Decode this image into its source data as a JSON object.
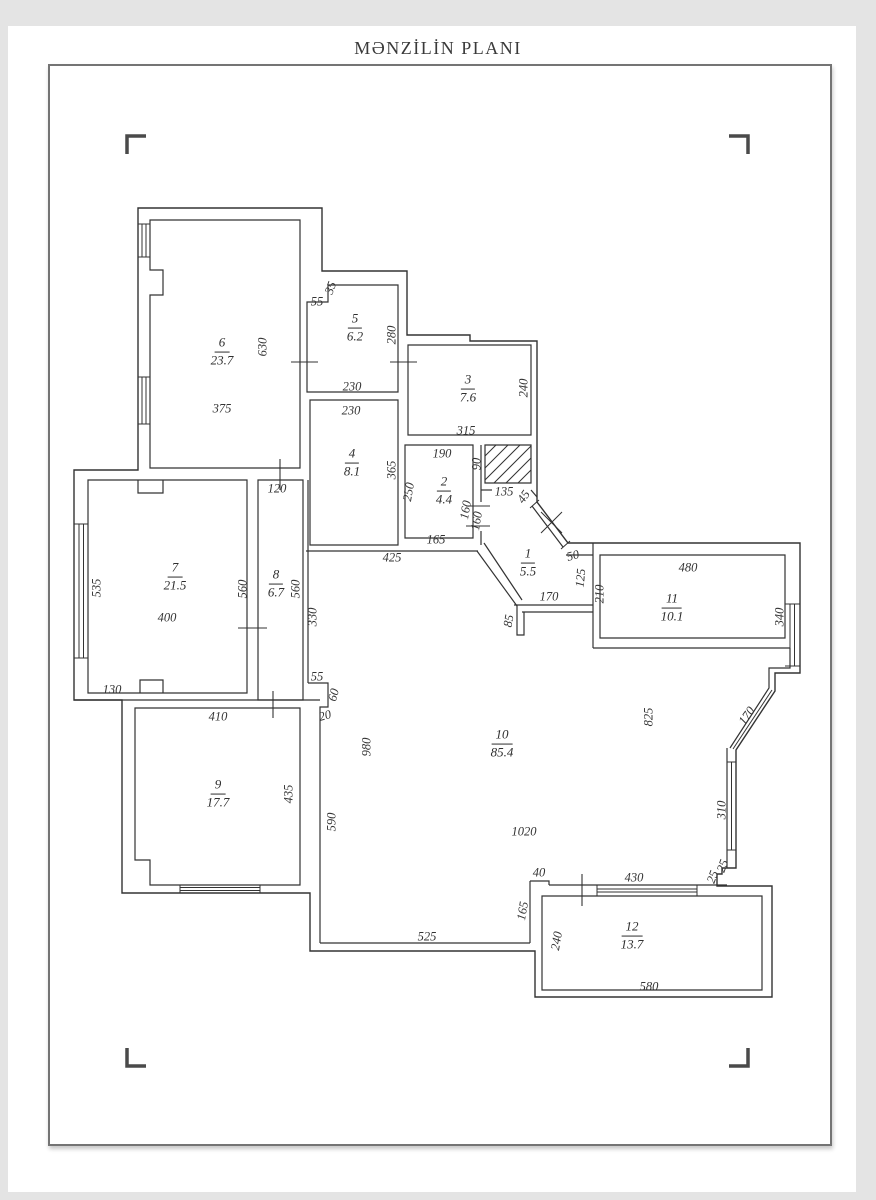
{
  "title": "MƏNZİLİN PLANI",
  "plan": {
    "rooms": [
      {
        "num": "6",
        "area": "23.7",
        "x": 222,
        "y": 352
      },
      {
        "num": "5",
        "area": "6.2",
        "x": 355,
        "y": 328
      },
      {
        "num": "3",
        "area": "7.6",
        "x": 468,
        "y": 389
      },
      {
        "num": "4",
        "area": "8.1",
        "x": 352,
        "y": 463
      },
      {
        "num": "2",
        "area": "4.4",
        "x": 444,
        "y": 491
      },
      {
        "num": "1",
        "area": "5.5",
        "x": 528,
        "y": 563
      },
      {
        "num": "7",
        "area": "21.5",
        "x": 175,
        "y": 577
      },
      {
        "num": "8",
        "area": "6.7",
        "x": 276,
        "y": 584
      },
      {
        "num": "9",
        "area": "17.7",
        "x": 218,
        "y": 794
      },
      {
        "num": "10",
        "area": "85.4",
        "x": 502,
        "y": 744
      },
      {
        "num": "11",
        "area": "10.1",
        "x": 672,
        "y": 608
      },
      {
        "num": "12",
        "area": "13.7",
        "x": 632,
        "y": 936
      }
    ],
    "dimensions": [
      {
        "t": "630",
        "x": 263,
        "y": 347,
        "r": -90
      },
      {
        "t": "375",
        "x": 222,
        "y": 409,
        "r": 0
      },
      {
        "t": "55",
        "x": 317,
        "y": 302,
        "r": 0
      },
      {
        "t": "35",
        "x": 331,
        "y": 288,
        "r": -70
      },
      {
        "t": "280",
        "x": 392,
        "y": 335,
        "r": -90
      },
      {
        "t": "230",
        "x": 352,
        "y": 387,
        "r": 0
      },
      {
        "t": "230",
        "x": 351,
        "y": 411,
        "r": 0
      },
      {
        "t": "315",
        "x": 466,
        "y": 431,
        "r": 0
      },
      {
        "t": "240",
        "x": 524,
        "y": 388,
        "r": -90
      },
      {
        "t": "365",
        "x": 392,
        "y": 470,
        "r": -90
      },
      {
        "t": "190",
        "x": 442,
        "y": 454,
        "r": 0
      },
      {
        "t": "90",
        "x": 477,
        "y": 464,
        "r": -90
      },
      {
        "t": "250",
        "x": 409,
        "y": 492,
        "r": -80
      },
      {
        "t": "135",
        "x": 504,
        "y": 492,
        "r": 0
      },
      {
        "t": "45",
        "x": 524,
        "y": 497,
        "r": -55
      },
      {
        "t": "160",
        "x": 466,
        "y": 510,
        "r": -80
      },
      {
        "t": "160",
        "x": 477,
        "y": 521,
        "r": -80
      },
      {
        "t": "165",
        "x": 436,
        "y": 540,
        "r": 0
      },
      {
        "t": "425",
        "x": 392,
        "y": 558,
        "r": 0
      },
      {
        "t": "50",
        "x": 573,
        "y": 556,
        "r": -15
      },
      {
        "t": "125",
        "x": 581,
        "y": 578,
        "r": -85
      },
      {
        "t": "170",
        "x": 549,
        "y": 597,
        "r": 0
      },
      {
        "t": "85",
        "x": 509,
        "y": 621,
        "r": -80
      },
      {
        "t": "210",
        "x": 600,
        "y": 594,
        "r": -90
      },
      {
        "t": "480",
        "x": 688,
        "y": 568,
        "r": 0
      },
      {
        "t": "340",
        "x": 780,
        "y": 617,
        "r": -90
      },
      {
        "t": "120",
        "x": 277,
        "y": 489,
        "r": 0
      },
      {
        "t": "560",
        "x": 243,
        "y": 589,
        "r": -90
      },
      {
        "t": "560",
        "x": 296,
        "y": 589,
        "r": -90
      },
      {
        "t": "535",
        "x": 97,
        "y": 588,
        "r": -90
      },
      {
        "t": "400",
        "x": 167,
        "y": 618,
        "r": 0
      },
      {
        "t": "130",
        "x": 112,
        "y": 690,
        "r": 0
      },
      {
        "t": "330",
        "x": 313,
        "y": 617,
        "r": -90
      },
      {
        "t": "55",
        "x": 317,
        "y": 677,
        "r": 0
      },
      {
        "t": "60",
        "x": 334,
        "y": 695,
        "r": -75
      },
      {
        "t": "20",
        "x": 325,
        "y": 716,
        "r": -15
      },
      {
        "t": "410",
        "x": 218,
        "y": 717,
        "r": 0
      },
      {
        "t": "435",
        "x": 289,
        "y": 794,
        "r": -90
      },
      {
        "t": "980",
        "x": 367,
        "y": 747,
        "r": -90
      },
      {
        "t": "590",
        "x": 332,
        "y": 822,
        "r": -90
      },
      {
        "t": "825",
        "x": 649,
        "y": 717,
        "r": -90
      },
      {
        "t": "1020",
        "x": 524,
        "y": 832,
        "r": 0
      },
      {
        "t": "525",
        "x": 427,
        "y": 937,
        "r": 0
      },
      {
        "t": "40",
        "x": 539,
        "y": 873,
        "r": 0
      },
      {
        "t": "165",
        "x": 523,
        "y": 911,
        "r": -80
      },
      {
        "t": "430",
        "x": 634,
        "y": 878,
        "r": 0
      },
      {
        "t": "240",
        "x": 557,
        "y": 941,
        "r": -80
      },
      {
        "t": "580",
        "x": 649,
        "y": 987,
        "r": 0
      },
      {
        "t": "170",
        "x": 747,
        "y": 716,
        "r": -55
      },
      {
        "t": "310",
        "x": 722,
        "y": 810,
        "r": -90
      },
      {
        "t": "25",
        "x": 713,
        "y": 877,
        "r": -70
      },
      {
        "t": "25",
        "x": 723,
        "y": 866,
        "r": -70
      }
    ]
  }
}
